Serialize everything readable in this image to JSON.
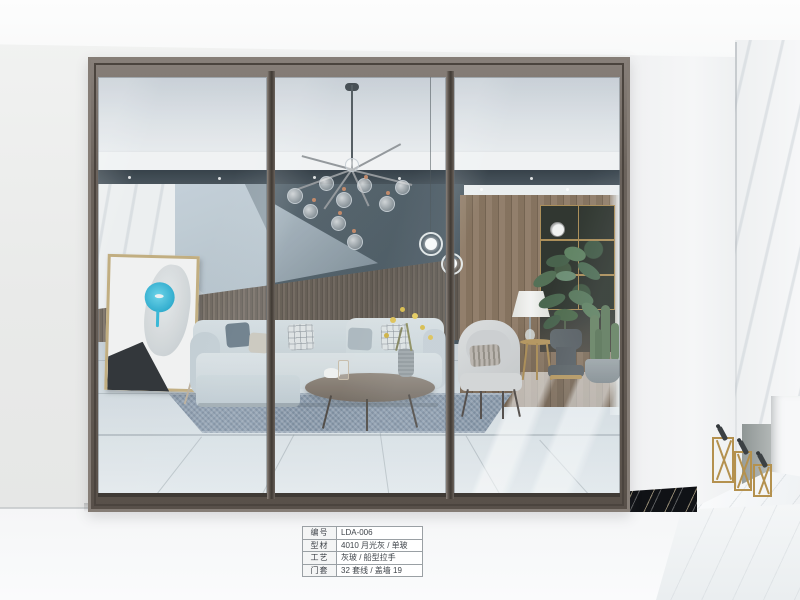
{
  "spec_table": {
    "rows": [
      {
        "label": "编号",
        "value": "LDA-006"
      },
      {
        "label": "型材",
        "value": "4010 月光灰 / 单玻"
      },
      {
        "label": "工艺",
        "value": "灰玻 / 船型拉手"
      },
      {
        "label": "门套",
        "value": "32 套线 / 盖墙 19"
      }
    ]
  },
  "colors": {
    "door_frame": "#6b635c",
    "glass_tint": "#cdd4da",
    "accent_wall_teal": "#475661",
    "wood_wainscot": "#6e645a",
    "artwork_cyan": "#2ab5d6",
    "gold_accent": "#b4914e",
    "rug_blue": "#8495a8",
    "black_marble": "#17191d"
  }
}
